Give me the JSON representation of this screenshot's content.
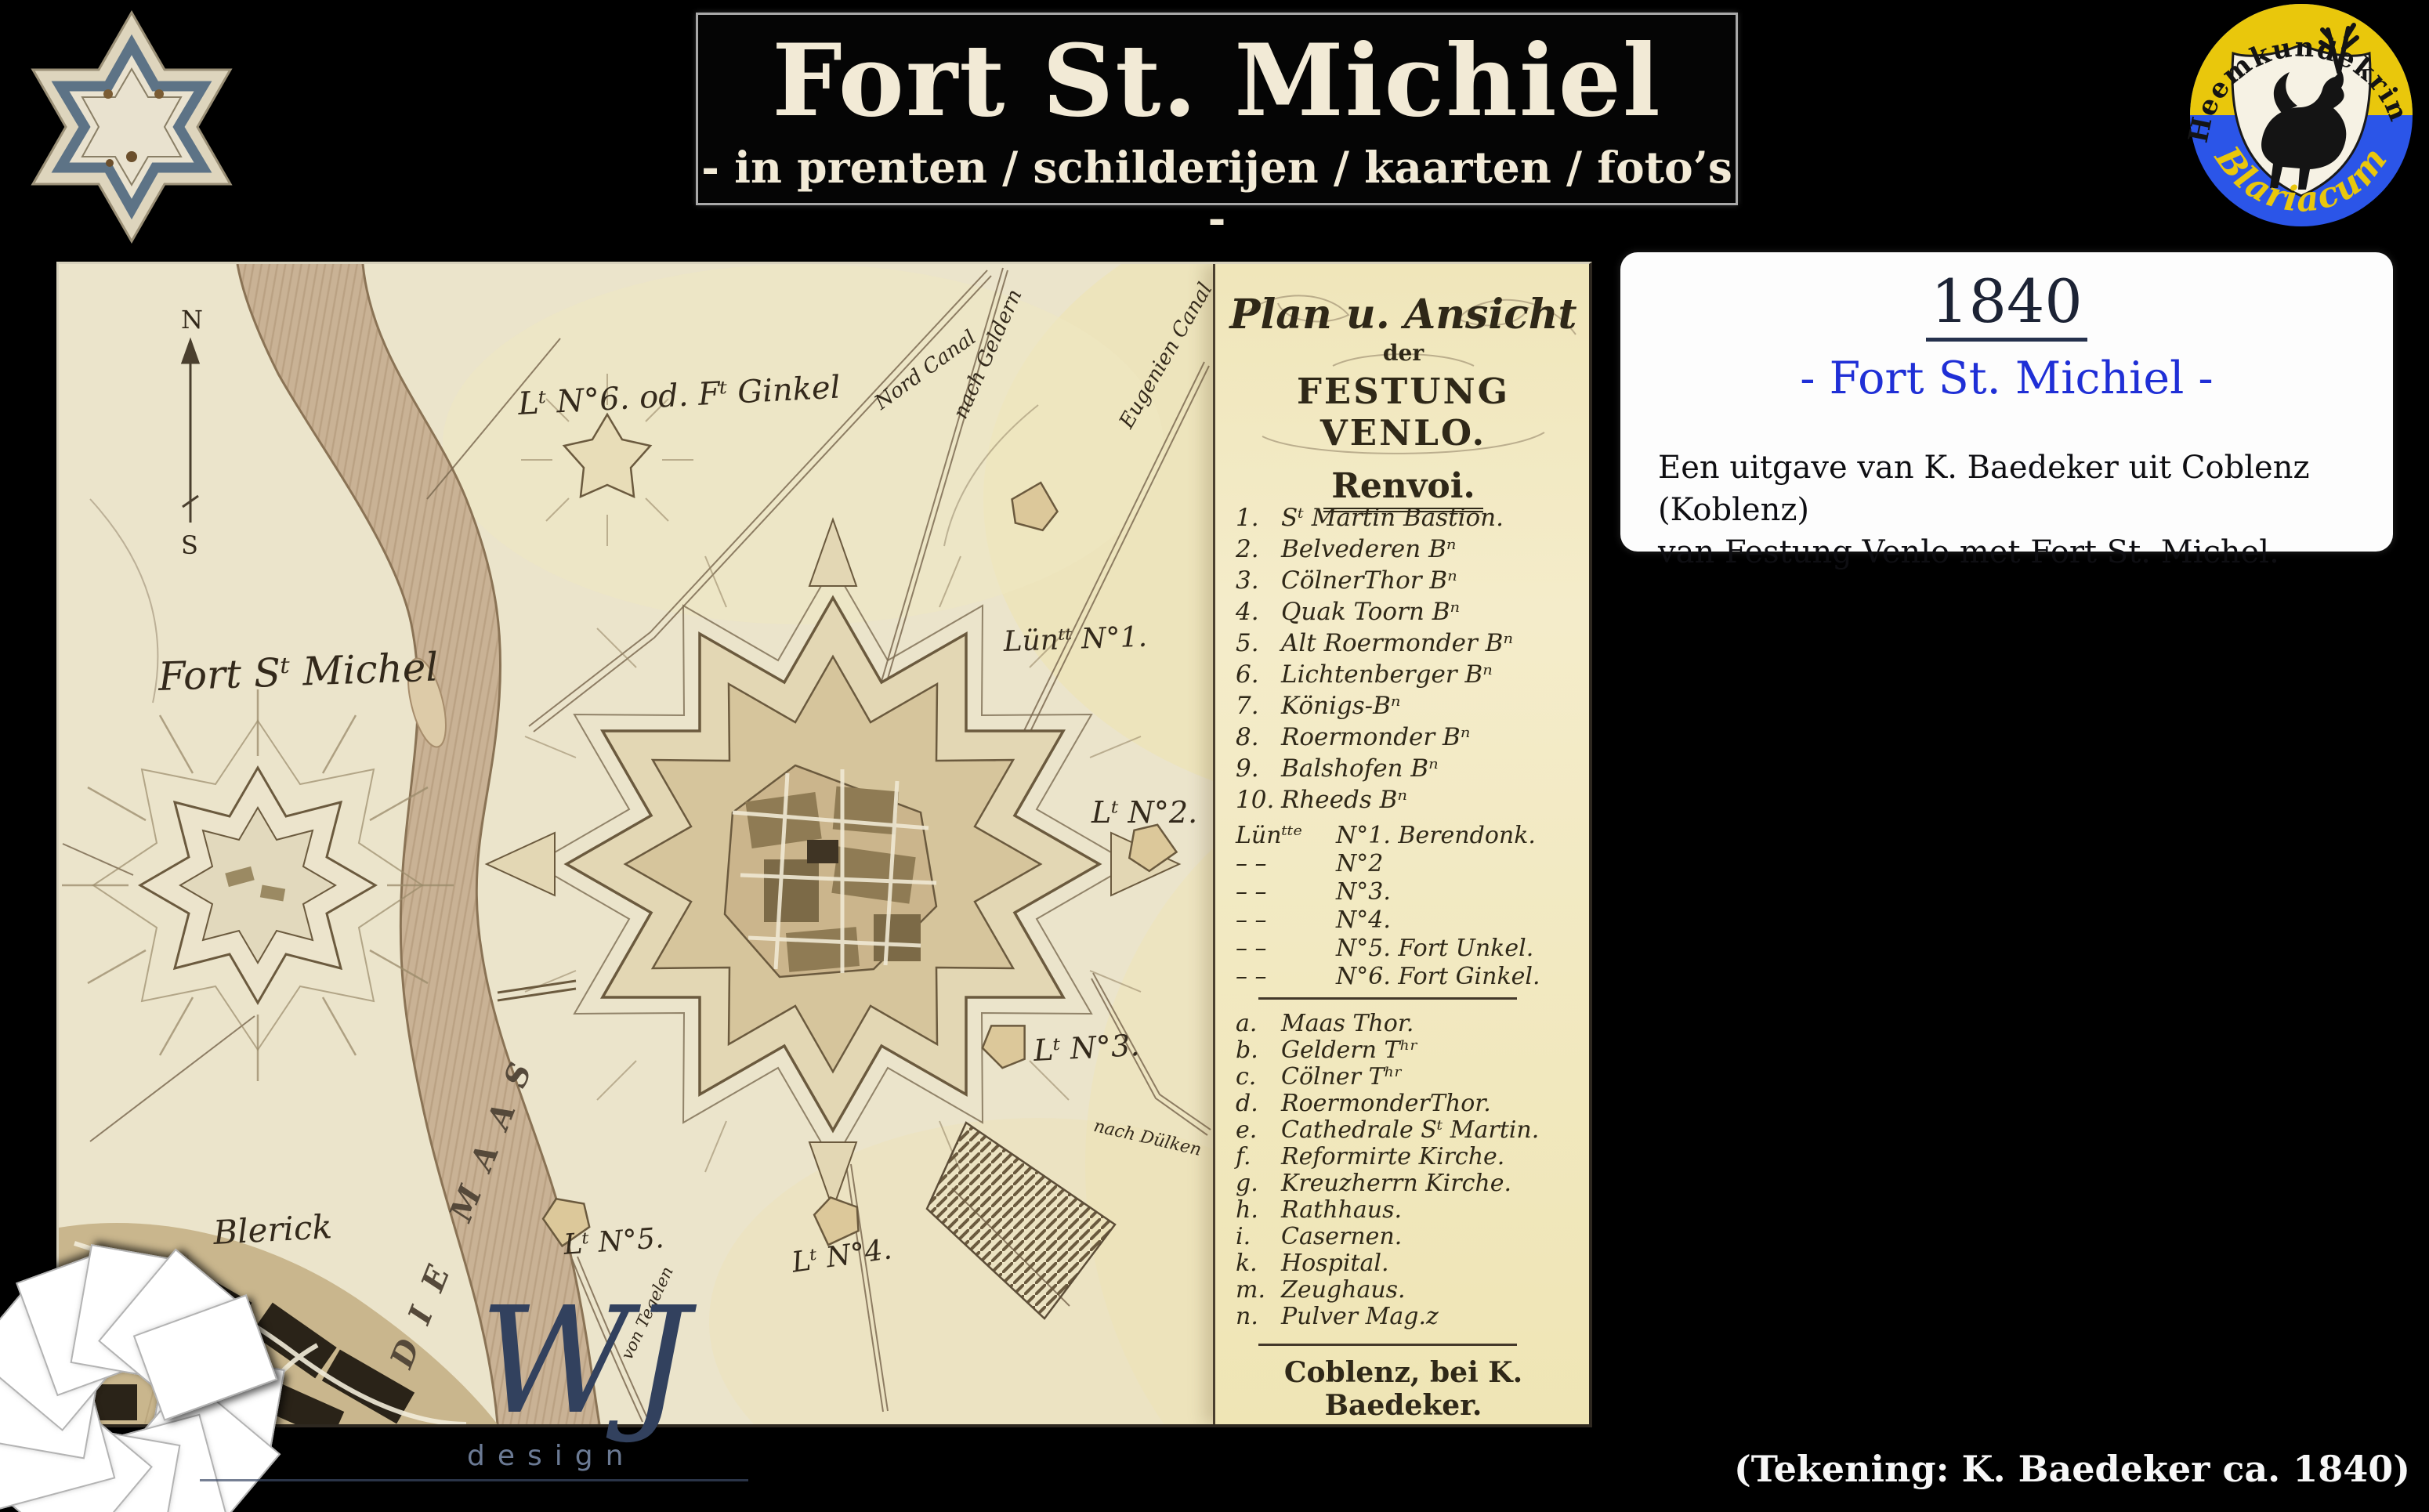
{
  "header": {
    "title": "Fort St. Michiel",
    "subtitle": "- in prenten / schilderijen / kaarten / foto’s -"
  },
  "logo_right": {
    "top_text": "Heemkundekring",
    "bottom_text": "Blariacum",
    "colors": {
      "yellow": "#e9c70c",
      "blue": "#2b55e8"
    }
  },
  "info_box": {
    "year": "1840",
    "subtitle": "- Fort St. Michiel -",
    "body_line1": "Een uitgave van K. Baedeker  uit Coblenz (Koblenz)",
    "body_line2": "van Festung Venlo met Fort St. Michel."
  },
  "caption": "(Tekening: K. Baedeker ca. 1840)",
  "watermark": {
    "initials": "WJ",
    "sub": "design"
  },
  "map": {
    "cartouche": {
      "line1": "Plan u. Ansicht",
      "line2": "der",
      "line3": "FESTUNG VENLO."
    },
    "legend": {
      "title": "Renvoi.",
      "numbered": [
        {
          "num": "1.",
          "text": "Sᵗ Martin Bastion."
        },
        {
          "num": "2.",
          "text": "Belvederen Bⁿ"
        },
        {
          "num": "3.",
          "text": "CölnerThor Bⁿ"
        },
        {
          "num": "4.",
          "text": "Quak Toorn Bⁿ"
        },
        {
          "num": "5.",
          "text": "Alt Roermonder Bⁿ"
        },
        {
          "num": "6.",
          "text": "Lichtenberger Bⁿ"
        },
        {
          "num": "7.",
          "text": "Königs-Bⁿ"
        },
        {
          "num": "8.",
          "text": "Roermonder Bⁿ"
        },
        {
          "num": "9.",
          "text": "Balshofen Bⁿ"
        },
        {
          "num": "10.",
          "text": "Rheeds Bⁿ"
        }
      ],
      "lunettes": [
        {
          "dash": "Lünᵗᵗᵉ",
          "label": "N°1. Berendonk."
        },
        {
          "dash": "– –",
          "label": "N°2"
        },
        {
          "dash": "– –",
          "label": "N°3."
        },
        {
          "dash": "– –",
          "label": "N°4."
        },
        {
          "dash": "– –",
          "label": "N°5. Fort Unkel."
        },
        {
          "dash": "– –",
          "label": "N°6. Fort Ginkel."
        }
      ],
      "lettered": [
        {
          "key": "a.",
          "text": "Maas Thor."
        },
        {
          "key": "b.",
          "text": "Geldern Tʰʳ"
        },
        {
          "key": "c.",
          "text": "Cölner Tʰʳ"
        },
        {
          "key": "d.",
          "text": "RoermonderThor."
        },
        {
          "key": "e.",
          "text": "Cathedrale Sᵗ Martin."
        },
        {
          "key": "f.",
          "text": "Reformirte Kirche."
        },
        {
          "key": "g.",
          "text": "Kreuzherrn Kirche."
        },
        {
          "key": "h.",
          "text": "Rathhaus."
        },
        {
          "key": "i.",
          "text": "Casernen."
        },
        {
          "key": "k.",
          "text": "Hospital."
        },
        {
          "key": "m.",
          "text": "Zeughaus."
        },
        {
          "key": "n.",
          "text": "Pulver Mag.z"
        }
      ],
      "publisher": "Coblenz, bei K. Baedeker."
    },
    "compass": {
      "north": "N",
      "south": "S"
    },
    "labels": {
      "ginkel": "Lᵗ N°6. od. Fᵗ Ginkel",
      "nord_canal": "Nord Canal",
      "nach_geldern": "nach Geldern",
      "eugenien_canal": "Eugenien Canal",
      "lun1": "Lünᵗᵗ N°1.",
      "fort_michel": "Fort Sᵗ Michel",
      "lt2": "Lᵗ N°2.",
      "lt3": "Lᵗ N°3.",
      "nach_dulken": "nach Dülken",
      "lt5": "Lᵗ N°5.",
      "lt4": "Lᵗ N°4.",
      "blerick": "Blerick",
      "die_maas": "DIE MAAS",
      "von_tegelen": "von Tegelen"
    }
  }
}
